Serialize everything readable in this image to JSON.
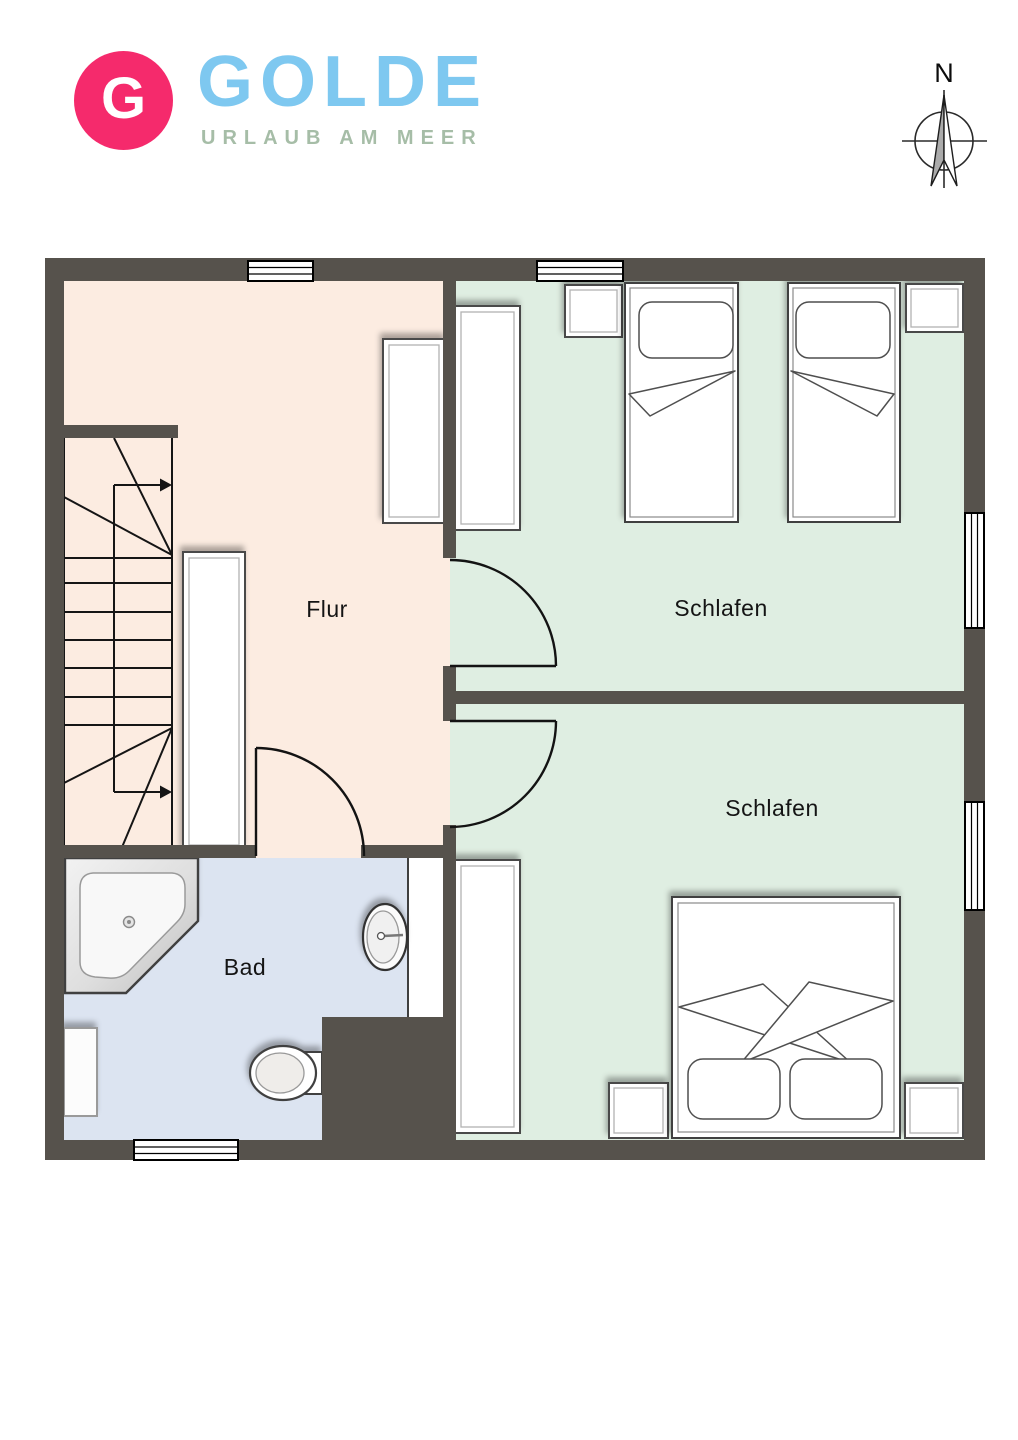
{
  "logo": {
    "monogram": "G",
    "brand": "GOLDE",
    "tagline": "URLAUB AM MEER"
  },
  "compass": {
    "label": "N"
  },
  "rooms": {
    "flur": {
      "label": "Flur"
    },
    "schlafen_top": {
      "label": "Schlafen"
    },
    "schlafen_bottom": {
      "label": "Schlafen"
    },
    "bad": {
      "label": "Bad"
    }
  },
  "fixtures": [
    "staircase",
    "wardrobe",
    "single-bed",
    "double-bed",
    "nightstand",
    "corner-bathtub",
    "washbasin",
    "toilet",
    "radiator",
    "window",
    "door-swing"
  ],
  "colors": {
    "wall": "#56524C",
    "flur_floor": "#FCECE1",
    "bedroom_floor": "#DFEEE2",
    "bath_floor": "#DCE4F1",
    "logo_badge": "#F52A6C",
    "logo_brand": "#7EC8F0",
    "logo_tagline": "#A6BDA7"
  }
}
